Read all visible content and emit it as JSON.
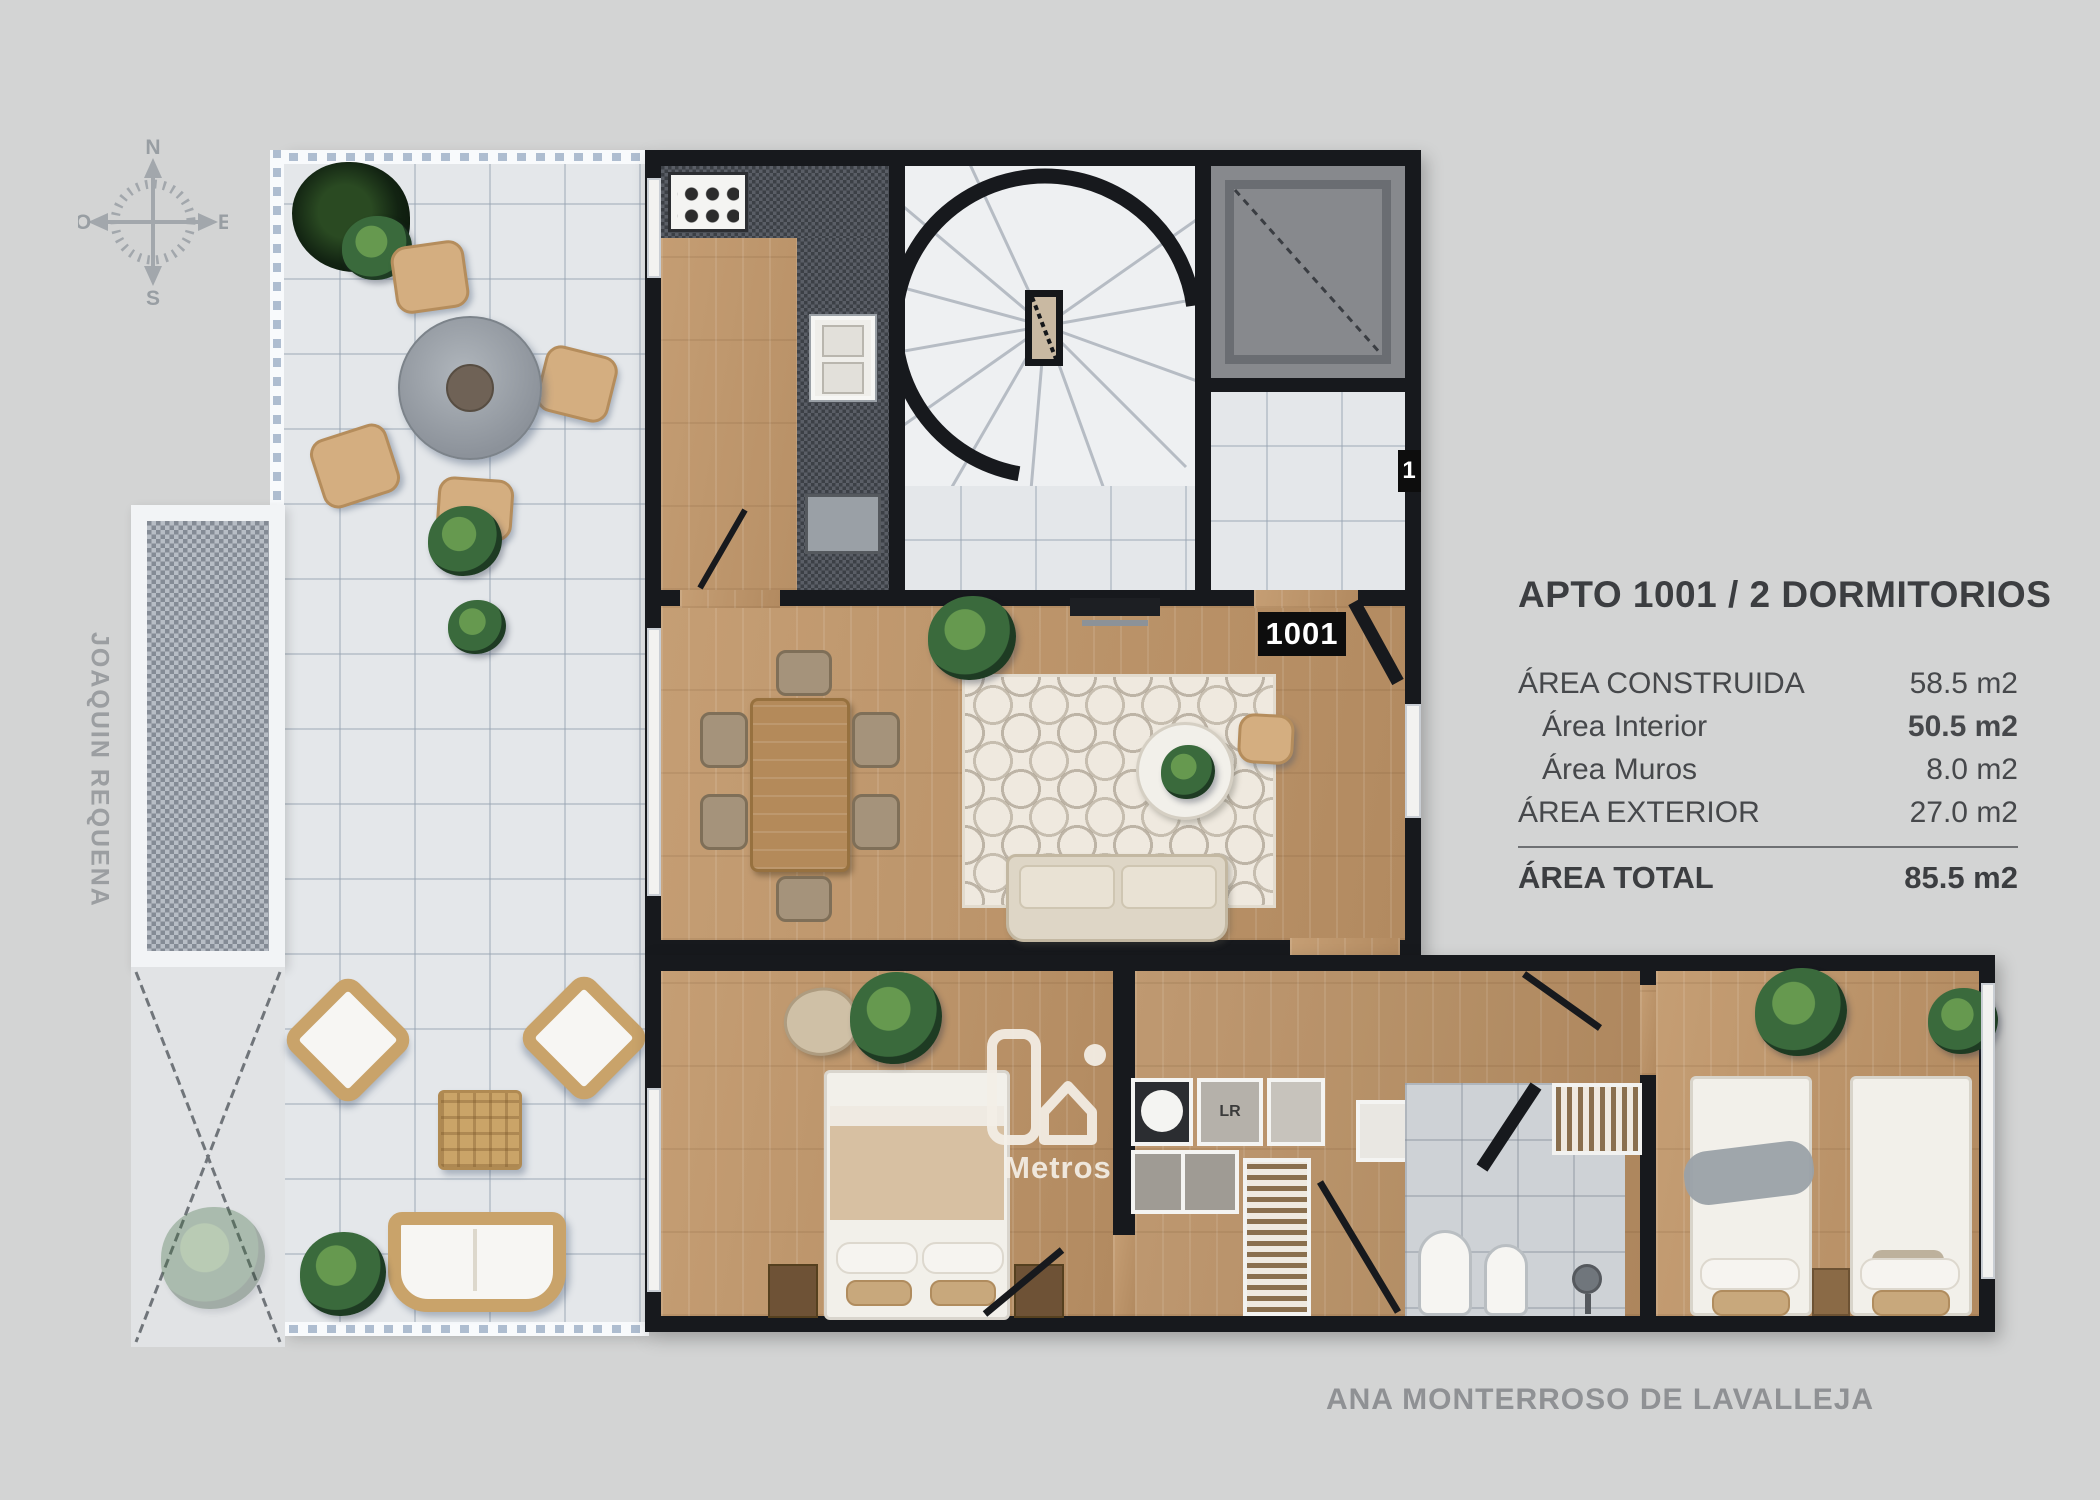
{
  "info_panel": {
    "title": "APTO 1001 / 2 DORMITORIOS",
    "rows": [
      {
        "label": "ÁREA CONSTRUIDA",
        "value": "58.5 m2"
      },
      {
        "label": "Área Interior",
        "value": "50.5 m2"
      },
      {
        "label": "Área Muros",
        "value": "8.0 m2"
      },
      {
        "label": "ÁREA EXTERIOR",
        "value": "27.0 m2"
      }
    ],
    "total_label": "ÁREA TOTAL",
    "total_value": "85.5 m2"
  },
  "streets": {
    "left": "JOAQUIN REQUENA",
    "bottom": "ANA MONTERROSO DE LAVALLEJA"
  },
  "compass": {
    "north": "N",
    "south": "S",
    "east": "E",
    "west": "O"
  },
  "plan": {
    "unit_tag": "1001",
    "unit_tag_partial": "1",
    "laundry_label": "LR"
  },
  "watermark": {
    "brand": "Metros"
  },
  "colors": {
    "background": "#d3d4d4",
    "walls": "#17191d",
    "wood_floor": "#c09a71",
    "terrace_tile": "#e4e7ea",
    "label_chip": "#0d0d0d",
    "text": "#46484b"
  }
}
